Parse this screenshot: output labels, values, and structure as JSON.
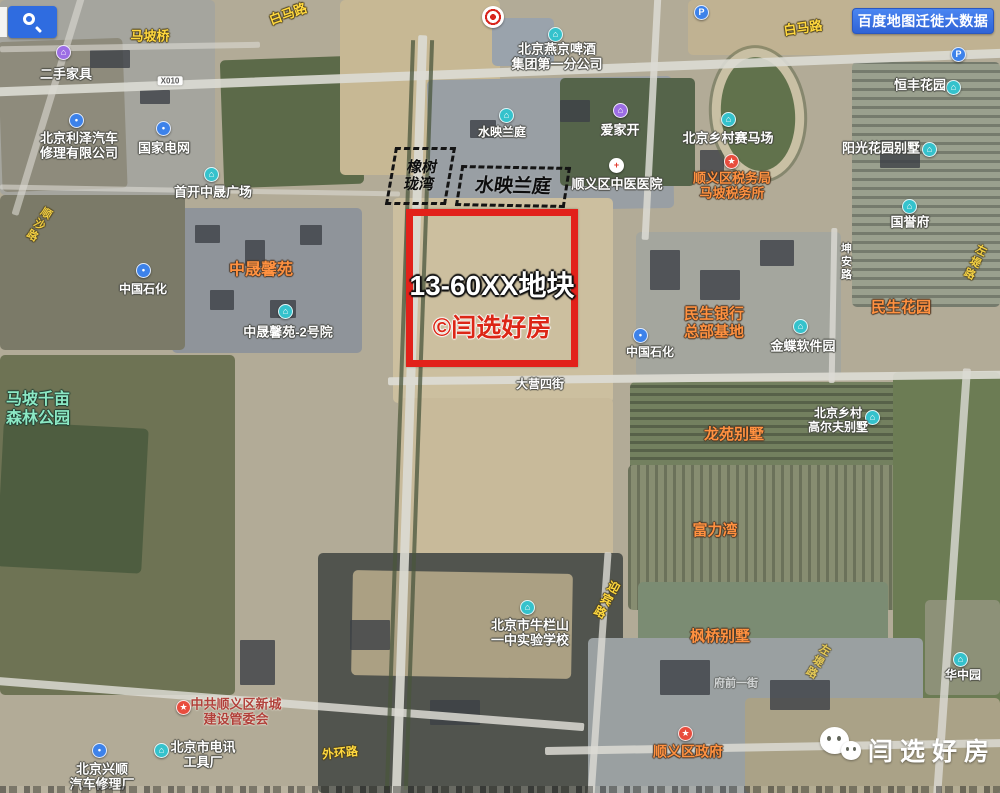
{
  "header": {
    "baidu_button_label": "百度地图迁徙大数据"
  },
  "plot_highlight": {
    "title": "13-60XX地块",
    "credit": "©闫选好房"
  },
  "dashed_areas": [
    {
      "name": "橡树珑湾",
      "lines": [
        "橡树",
        "珑湾"
      ]
    },
    {
      "name": "水映兰庭",
      "lines": [
        "水映兰庭"
      ]
    }
  ],
  "wechat_badge": {
    "name": "闫选好房"
  },
  "colors": {
    "plot_border_red": "#e2211a",
    "credit_red": "#dc2616",
    "poi_orange": "#ff9140",
    "road_yellow": "#ffd83e",
    "park_green": "#8ce8c4",
    "marker_teal": "#35c2cc",
    "marker_blue": "#3d82ea",
    "marker_purple": "#9c6de4",
    "marker_red": "#e84c3d",
    "baidu_blue": "#2f6ce0"
  },
  "map": {
    "labels": [
      {
        "lines": [
          "马坡桥"
        ],
        "x": 150,
        "y": 36,
        "type": "yellow",
        "size": 13
      },
      {
        "lines": [
          "白马路"
        ],
        "x": 288,
        "y": 14,
        "type": "yellow",
        "size": 13,
        "rot": -20
      },
      {
        "lines": [
          "白马路"
        ],
        "x": 803,
        "y": 28,
        "type": "yellow",
        "size": 13,
        "rot": -8
      },
      {
        "lines": [
          "X010"
        ],
        "x": 170,
        "y": 81,
        "type": "badge"
      },
      {
        "lines": [
          "二手家具"
        ],
        "x": 66,
        "y": 74,
        "type": "white",
        "size": 13
      },
      {
        "lines": [
          "北京利泽汽车",
          "修理有限公司"
        ],
        "x": 79,
        "y": 146,
        "type": "white",
        "size": 13
      },
      {
        "lines": [
          "国家电网"
        ],
        "x": 164,
        "y": 148,
        "type": "white",
        "size": 13
      },
      {
        "lines": [
          "首开中晟广场"
        ],
        "x": 213,
        "y": 192,
        "type": "white",
        "size": 13
      },
      {
        "lines": [
          "北京燕京啤酒",
          "集团第一分公司"
        ],
        "x": 557,
        "y": 57,
        "type": "white",
        "size": 13
      },
      {
        "lines": [
          "水映兰庭"
        ],
        "x": 502,
        "y": 132,
        "type": "white",
        "size": 12
      },
      {
        "lines": [
          "爱家开"
        ],
        "x": 620,
        "y": 130,
        "type": "white",
        "size": 13
      },
      {
        "lines": [
          "顺义区中医医院"
        ],
        "x": 617,
        "y": 184,
        "type": "white",
        "size": 13
      },
      {
        "lines": [
          "顺义区税务局",
          "马坡税务所"
        ],
        "x": 732,
        "y": 186,
        "type": "orange",
        "size": 13
      },
      {
        "lines": [
          "北京乡村赛马场"
        ],
        "x": 728,
        "y": 138,
        "type": "white",
        "size": 13
      },
      {
        "lines": [
          "恒丰花园"
        ],
        "x": 920,
        "y": 85,
        "type": "white",
        "size": 13
      },
      {
        "lines": [
          "阳光花园别墅"
        ],
        "x": 881,
        "y": 148,
        "type": "white",
        "size": 13
      },
      {
        "lines": [
          "国誉府"
        ],
        "x": 910,
        "y": 222,
        "type": "white",
        "size": 13
      },
      {
        "lines": [
          "坤安路"
        ],
        "x": 845,
        "y": 262,
        "type": "roadwhite",
        "size": 11,
        "vert": true
      },
      {
        "lines": [
          "民生银行",
          "总部基地"
        ],
        "x": 714,
        "y": 323,
        "type": "orange",
        "size": 15
      },
      {
        "lines": [
          "金蝶软件园"
        ],
        "x": 803,
        "y": 346,
        "type": "white",
        "size": 13
      },
      {
        "lines": [
          "民生花园"
        ],
        "x": 901,
        "y": 308,
        "type": "orange",
        "size": 15
      },
      {
        "lines": [
          "中国石化"
        ],
        "x": 650,
        "y": 352,
        "type": "white",
        "size": 12
      },
      {
        "lines": [
          "中晟馨苑"
        ],
        "x": 261,
        "y": 271,
        "type": "orange",
        "size": 16
      },
      {
        "lines": [
          "中国石化"
        ],
        "x": 143,
        "y": 289,
        "type": "white",
        "size": 12
      },
      {
        "lines": [
          "中晟馨苑-2号院"
        ],
        "x": 288,
        "y": 332,
        "type": "white",
        "size": 13
      },
      {
        "lines": [
          "马坡千亩",
          "森林公园"
        ],
        "x": 38,
        "y": 410,
        "type": "park",
        "size": 16
      },
      {
        "lines": [
          "大营四街"
        ],
        "x": 540,
        "y": 384,
        "type": "roadwhite",
        "size": 12
      },
      {
        "lines": [
          "龙苑别墅"
        ],
        "x": 734,
        "y": 435,
        "type": "orange",
        "size": 15
      },
      {
        "lines": [
          "北京乡村",
          "高尔夫别墅"
        ],
        "x": 838,
        "y": 420,
        "type": "white",
        "size": 12
      },
      {
        "lines": [
          "富力湾"
        ],
        "x": 715,
        "y": 531,
        "type": "orange",
        "size": 15
      },
      {
        "lines": [
          "枫桥别墅"
        ],
        "x": 720,
        "y": 637,
        "type": "orange",
        "size": 15
      },
      {
        "lines": [
          "北京市牛栏山",
          "一中实验学校"
        ],
        "x": 530,
        "y": 633,
        "type": "white",
        "size": 13
      },
      {
        "lines": [
          "迎宾路"
        ],
        "x": 606,
        "y": 600,
        "type": "yellow",
        "size": 12,
        "vert": true,
        "rot": 28
      },
      {
        "lines": [
          "外环路"
        ],
        "x": 340,
        "y": 753,
        "type": "yellow",
        "size": 12,
        "rot": -6
      },
      {
        "lines": [
          "北京市电讯",
          "工具厂"
        ],
        "x": 203,
        "y": 755,
        "type": "white",
        "size": 13
      },
      {
        "lines": [
          "北京兴顺",
          "汽车修理厂"
        ],
        "x": 102,
        "y": 777,
        "type": "white",
        "size": 13
      },
      {
        "lines": [
          "中共顺义区新城",
          "建设管委会"
        ],
        "x": 236,
        "y": 712,
        "type": "red",
        "size": 13
      },
      {
        "lines": [
          "顺义区政府"
        ],
        "x": 688,
        "y": 752,
        "type": "orange",
        "size": 14
      },
      {
        "lines": [
          "华中园"
        ],
        "x": 963,
        "y": 675,
        "type": "white",
        "size": 12
      },
      {
        "lines": [
          "府前一街"
        ],
        "x": 736,
        "y": 684,
        "type": "roadwhite",
        "size": 11,
        "op": 0.55
      },
      {
        "lines": [
          "顺沙路"
        ],
        "x": 38,
        "y": 224,
        "type": "yellow",
        "size": 11,
        "vert": true,
        "rot": 32,
        "op": 0.9
      },
      {
        "lines": [
          "左堤路"
        ],
        "x": 974,
        "y": 262,
        "type": "yellow",
        "size": 11,
        "vert": true,
        "rot": 26,
        "op": 0.9
      },
      {
        "lines": [
          "左堤路"
        ],
        "x": 817,
        "y": 661,
        "type": "yellow",
        "size": 11,
        "vert": true,
        "rot": 30,
        "op": 0.75
      }
    ],
    "markers": [
      {
        "x": 701,
        "y": 12,
        "name": "parking-icon",
        "glyph": "P",
        "bg": "#3d82ea",
        "fg": "#fff"
      },
      {
        "x": 958,
        "y": 54,
        "name": "parking-icon",
        "glyph": "P",
        "bg": "#3d82ea",
        "fg": "#fff"
      },
      {
        "x": 555,
        "y": 34,
        "name": "poi-icon",
        "glyph": "⌂",
        "bg": "#35c2cc",
        "fg": "#fff"
      },
      {
        "x": 506,
        "y": 115,
        "name": "poi-icon",
        "glyph": "⌂",
        "bg": "#35c2cc",
        "fg": "#fff"
      },
      {
        "x": 620,
        "y": 110,
        "name": "poi-icon",
        "glyph": "⌂",
        "bg": "#9c6de4",
        "fg": "#fff"
      },
      {
        "x": 63,
        "y": 52,
        "name": "poi-icon",
        "glyph": "⌂",
        "bg": "#9c6de4",
        "fg": "#fff"
      },
      {
        "x": 76,
        "y": 120,
        "name": "car-repair-icon",
        "glyph": "•",
        "bg": "#3d82ea",
        "fg": "#fff"
      },
      {
        "x": 163,
        "y": 128,
        "name": "power-grid-icon",
        "glyph": "•",
        "bg": "#3d82ea",
        "fg": "#fff"
      },
      {
        "x": 211,
        "y": 174,
        "name": "poi-icon",
        "glyph": "⌂",
        "bg": "#35c2cc",
        "fg": "#fff"
      },
      {
        "x": 143,
        "y": 270,
        "name": "gas-station-icon",
        "glyph": "•",
        "bg": "#3d82ea",
        "fg": "#fff"
      },
      {
        "x": 640,
        "y": 335,
        "name": "gas-station-icon",
        "glyph": "•",
        "bg": "#3d82ea",
        "fg": "#fff"
      },
      {
        "x": 285,
        "y": 311,
        "name": "poi-icon",
        "glyph": "⌂",
        "bg": "#35c2cc",
        "fg": "#fff"
      },
      {
        "x": 728,
        "y": 119,
        "name": "poi-icon",
        "glyph": "⌂",
        "bg": "#35c2cc",
        "fg": "#fff"
      },
      {
        "x": 953,
        "y": 87,
        "name": "poi-icon",
        "glyph": "⌂",
        "bg": "#35c2cc",
        "fg": "#fff"
      },
      {
        "x": 929,
        "y": 149,
        "name": "poi-icon",
        "glyph": "⌂",
        "bg": "#35c2cc",
        "fg": "#fff"
      },
      {
        "x": 909,
        "y": 206,
        "name": "poi-icon",
        "glyph": "⌂",
        "bg": "#35c2cc",
        "fg": "#fff"
      },
      {
        "x": 800,
        "y": 326,
        "name": "poi-icon",
        "glyph": "⌂",
        "bg": "#35c2cc",
        "fg": "#fff"
      },
      {
        "x": 872,
        "y": 417,
        "name": "poi-icon",
        "glyph": "⌂",
        "bg": "#35c2cc",
        "fg": "#fff"
      },
      {
        "x": 527,
        "y": 607,
        "name": "school-icon",
        "glyph": "⌂",
        "bg": "#35c2cc",
        "fg": "#fff"
      },
      {
        "x": 960,
        "y": 659,
        "name": "poi-icon",
        "glyph": "⌂",
        "bg": "#35c2cc",
        "fg": "#fff"
      },
      {
        "x": 161,
        "y": 750,
        "name": "poi-icon",
        "glyph": "⌂",
        "bg": "#35c2cc",
        "fg": "#fff"
      },
      {
        "x": 99,
        "y": 750,
        "name": "car-repair-icon",
        "glyph": "•",
        "bg": "#3d82ea",
        "fg": "#fff"
      },
      {
        "x": 731,
        "y": 161,
        "name": "government-star-icon",
        "glyph": "★",
        "bg": "#e84c3d",
        "fg": "#fff"
      },
      {
        "x": 183,
        "y": 707,
        "name": "government-star-icon",
        "glyph": "★",
        "bg": "#e84c3d",
        "fg": "#fff"
      },
      {
        "x": 685,
        "y": 733,
        "name": "government-star-icon",
        "glyph": "★",
        "bg": "#e84c3d",
        "fg": "#fff"
      },
      {
        "x": 616,
        "y": 165,
        "name": "hospital-cross-icon",
        "glyph": "+",
        "bg": "#ffffff",
        "fg": "#e23a2e"
      }
    ]
  }
}
